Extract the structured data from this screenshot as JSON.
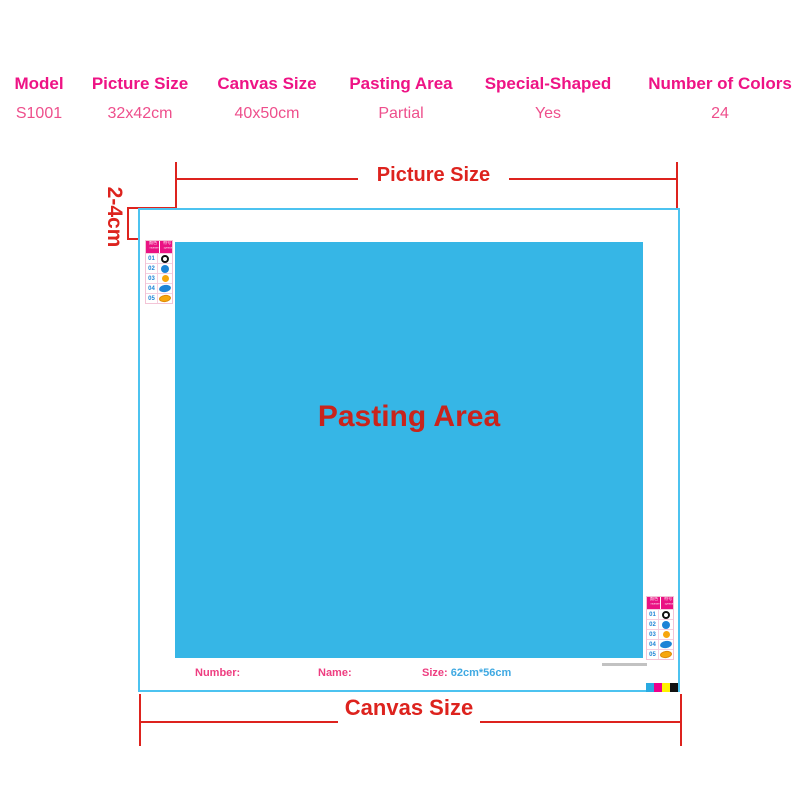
{
  "spec_table": {
    "columns": [
      {
        "label": "Model",
        "value": "S1001"
      },
      {
        "label": "Picture Size",
        "value": "32x42cm"
      },
      {
        "label": "Canvas Size",
        "value": "40x50cm"
      },
      {
        "label": "Pasting Area",
        "value": "Partial"
      },
      {
        "label": "Special-Shaped",
        "value": "Yes"
      },
      {
        "label": "Number of Colors",
        "value": "24"
      }
    ]
  },
  "diagram": {
    "picture_size_label": "Picture Size",
    "canvas_size_label": "Canvas Size",
    "margin_label": "2-4cm",
    "pasting_area_label": "Pasting Area",
    "footer": {
      "number_label": "Number:",
      "name_label": "Name:",
      "size_label": "Size:",
      "size_value": "62cm*56cm"
    },
    "legend": {
      "header": [
        {
          "cn": "颜色",
          "en": "Number"
        },
        {
          "cn": "符号",
          "en": "Symbol"
        }
      ],
      "rows": [
        {
          "num": "01",
          "symbol": "ring-black"
        },
        {
          "num": "02",
          "symbol": "circle-blue"
        },
        {
          "num": "03",
          "symbol": "circle-yellow"
        },
        {
          "num": "04",
          "symbol": "oval-blue"
        },
        {
          "num": "05",
          "symbol": "oval-orange"
        }
      ]
    },
    "cmyk_bar": [
      "#29aae1",
      "#ec008c",
      "#fff200",
      "#111111"
    ]
  },
  "colors": {
    "annotation_red": "#dd231e",
    "pasting_text_red": "#c9241c",
    "table_header_pink": "#ee1385",
    "table_value_pink": "#ee4f8c",
    "pasting_area_blue": "#36b6e6",
    "canvas_border_cyan": "#4cc3f0",
    "legend_header_magenta": "#ea1283",
    "legend_number_blue": "#1d84d6",
    "symbol_yellow": "#f6a70c",
    "footer_pink": "#ee3d80",
    "footer_size_blue": "#3fa9e2"
  }
}
